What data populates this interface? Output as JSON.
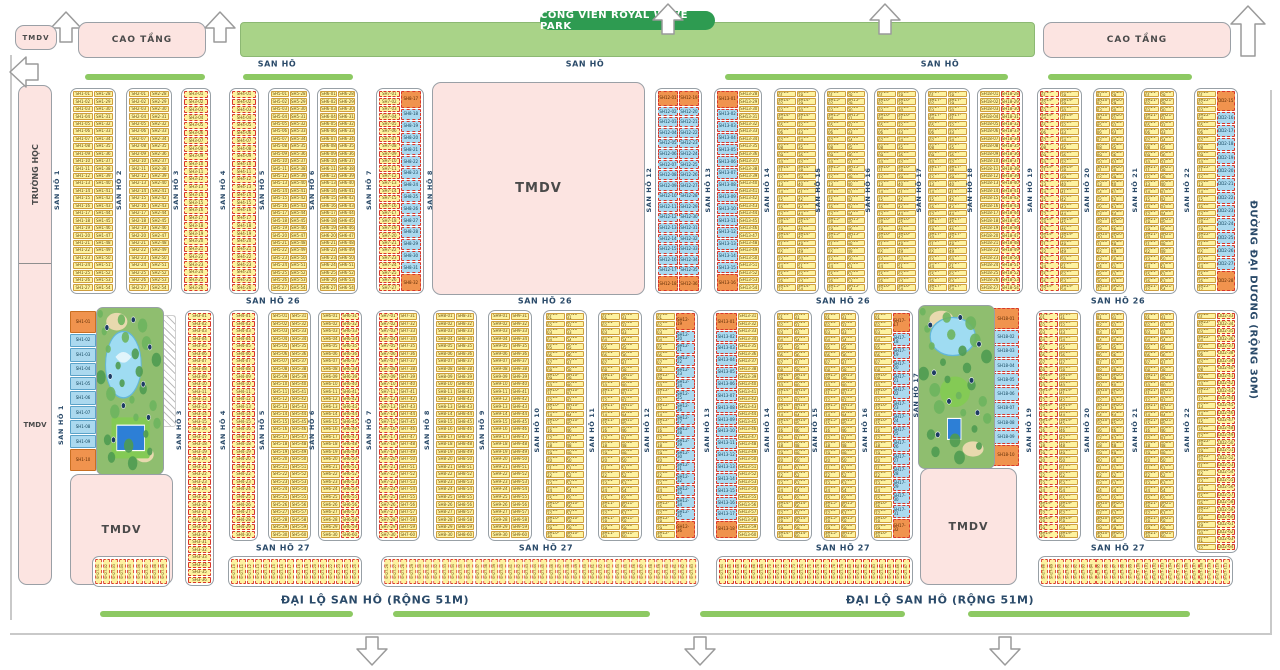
{
  "banner": {
    "label": "CÔNG VIÊN ROYAL WAVE PARK"
  },
  "left_column": {
    "top_label": "TRƯỜNG HỌC",
    "bottom_label": "TMDV",
    "x": 18,
    "y": 85,
    "w": 34,
    "h": 500,
    "divider_y": 177
  },
  "area_blocks": [
    {
      "id": "tmdv-top-left",
      "label": "TMDV",
      "x": 15,
      "y": 25,
      "w": 42,
      "h": 25,
      "fs": 7
    },
    {
      "id": "cao-tang-left",
      "label": "CAO TẦNG",
      "x": 78,
      "y": 22,
      "w": 128,
      "h": 36,
      "fs": 9
    },
    {
      "id": "cao-tang-right",
      "label": "CAO TẦNG",
      "x": 1043,
      "y": 22,
      "w": 188,
      "h": 36,
      "fs": 9
    },
    {
      "id": "tmdv-center",
      "label": "TMDV",
      "x": 432,
      "y": 82,
      "w": 213,
      "h": 213,
      "fs": 13
    },
    {
      "id": "tmdv-bottom-left",
      "label": "TMDV",
      "x": 70,
      "y": 474,
      "w": 103,
      "h": 111,
      "fs": 11
    },
    {
      "id": "tmdv-bottom-right",
      "label": "TMDV",
      "x": 920,
      "y": 468,
      "w": 97,
      "h": 117,
      "fs": 11
    }
  ],
  "road_labels_h": [
    {
      "t": "SAN HÔ",
      "x": 277,
      "y": 64,
      "fs": 8
    },
    {
      "t": "SAN HÔ",
      "x": 585,
      "y": 64,
      "fs": 8
    },
    {
      "t": "SAN HÔ",
      "x": 940,
      "y": 64,
      "fs": 8
    },
    {
      "t": "SAN HÔ 26",
      "x": 273,
      "y": 301,
      "fs": 8
    },
    {
      "t": "SAN HÔ 26",
      "x": 545,
      "y": 301,
      "fs": 8
    },
    {
      "t": "SAN HÔ 26",
      "x": 843,
      "y": 301,
      "fs": 8
    },
    {
      "t": "SAN HÔ 26",
      "x": 1118,
      "y": 301,
      "fs": 8
    },
    {
      "t": "SAN HÔ 27",
      "x": 283,
      "y": 548,
      "fs": 8
    },
    {
      "t": "SAN HÔ 27",
      "x": 546,
      "y": 548,
      "fs": 8
    },
    {
      "t": "SAN HÔ 27",
      "x": 843,
      "y": 548,
      "fs": 8
    },
    {
      "t": "SAN HÔ 27",
      "x": 1118,
      "y": 548,
      "fs": 8
    },
    {
      "t": "ĐẠI LỘ SAN HÔ (RỘNG 51M)",
      "x": 375,
      "y": 600,
      "fs": 11
    },
    {
      "t": "ĐẠI LỘ SAN HÔ (RỘNG 51M)",
      "x": 940,
      "y": 600,
      "fs": 11
    }
  ],
  "road_labels_v": [
    {
      "t": "SAN HÔ 1",
      "x": 57,
      "cy": 190
    },
    {
      "t": "SAN HÔ 2",
      "x": 119,
      "cy": 190
    },
    {
      "t": "SAN HÔ 3",
      "x": 176,
      "cy": 190
    },
    {
      "t": "SAN HÔ 4",
      "x": 223,
      "cy": 190
    },
    {
      "t": "SAN HÔ 5",
      "x": 262,
      "cy": 190
    },
    {
      "t": "SAN HÔ 6",
      "x": 312,
      "cy": 190
    },
    {
      "t": "SAN HÔ 7",
      "x": 369,
      "cy": 190
    },
    {
      "t": "SAN HÔ 8",
      "x": 430,
      "cy": 190
    },
    {
      "t": "SAN HÔ 12",
      "x": 649,
      "cy": 190
    },
    {
      "t": "SAN HÔ 13",
      "x": 708,
      "cy": 190
    },
    {
      "t": "SAN HÔ 14",
      "x": 767,
      "cy": 190
    },
    {
      "t": "SAN HÔ 15",
      "x": 818,
      "cy": 190
    },
    {
      "t": "SAN HÔ 16",
      "x": 868,
      "cy": 190
    },
    {
      "t": "SAN HÔ 17",
      "x": 919,
      "cy": 190
    },
    {
      "t": "SAN HÔ 18",
      "x": 970,
      "cy": 190
    },
    {
      "t": "SAN HÔ 19",
      "x": 1030,
      "cy": 190
    },
    {
      "t": "SAN HÔ 20",
      "x": 1087,
      "cy": 190
    },
    {
      "t": "SAN HÔ 21",
      "x": 1135,
      "cy": 190
    },
    {
      "t": "SAN HÔ 22",
      "x": 1187,
      "cy": 190
    },
    {
      "t": "SAN HÔ 1",
      "x": 61,
      "cy": 425
    },
    {
      "t": "SAN HÔ 3",
      "x": 179,
      "cy": 430
    },
    {
      "t": "SAN HÔ 4",
      "x": 223,
      "cy": 430
    },
    {
      "t": "SAN HÔ 5",
      "x": 262,
      "cy": 430
    },
    {
      "t": "SAN HÔ 6",
      "x": 312,
      "cy": 430
    },
    {
      "t": "SAN HÔ 7",
      "x": 369,
      "cy": 430
    },
    {
      "t": "SAN HÔ 8",
      "x": 427,
      "cy": 430
    },
    {
      "t": "SAN HÔ 9",
      "x": 482,
      "cy": 430
    },
    {
      "t": "SAN HÔ 10",
      "x": 537,
      "cy": 430
    },
    {
      "t": "SAN HÔ 11",
      "x": 592,
      "cy": 430
    },
    {
      "t": "SAN HÔ 12",
      "x": 647,
      "cy": 430
    },
    {
      "t": "SAN HÔ 13",
      "x": 707,
      "cy": 430
    },
    {
      "t": "SAN HÔ 14",
      "x": 767,
      "cy": 430
    },
    {
      "t": "SAN HÔ 15",
      "x": 815,
      "cy": 430
    },
    {
      "t": "SAN HÔ 16",
      "x": 865,
      "cy": 430
    },
    {
      "t": "SAN HÔ 17",
      "x": 916,
      "cy": 395
    },
    {
      "t": "SAN HÔ 19",
      "x": 1029,
      "cy": 430
    },
    {
      "t": "SAN HÔ 20",
      "x": 1087,
      "cy": 430
    },
    {
      "t": "SAN HÔ 21",
      "x": 1135,
      "cy": 430
    },
    {
      "t": "SAN HÔ 22",
      "x": 1187,
      "cy": 430
    },
    {
      "t": "ĐƯỜNG ĐẠI DƯƠNG (RỘNG 30M)",
      "x": 1253,
      "cy": 300,
      "rot": 90,
      "fs": 10
    }
  ],
  "green_bars": {
    "top_y": 74,
    "bottom_y": 611,
    "top": [
      [
        85,
        120
      ],
      [
        243,
        110
      ],
      [
        725,
        283
      ],
      [
        1048,
        144
      ]
    ],
    "bottom": [
      [
        100,
        253
      ],
      [
        393,
        257
      ],
      [
        700,
        205
      ],
      [
        968,
        222
      ]
    ]
  },
  "strips": [
    {
      "x": 70,
      "y": 88,
      "w": 46,
      "h": 206,
      "rows": 27,
      "cols": [
        {
          "p": "SH1",
          "c": "y"
        },
        {
          "p": "SH1",
          "c": "y"
        }
      ]
    },
    {
      "x": 126,
      "y": 88,
      "w": 46,
      "h": 206,
      "rows": 27,
      "cols": [
        {
          "p": "SH2",
          "c": "y"
        },
        {
          "p": "SH2",
          "c": "y"
        }
      ]
    },
    {
      "x": 181,
      "y": 88,
      "w": 30,
      "h": 206,
      "rows": 26,
      "cols": [
        {
          "p": "SH3",
          "c": "y",
          "d": 1
        }
      ]
    },
    {
      "x": 229,
      "y": 88,
      "w": 30,
      "h": 206,
      "rows": 26,
      "cols": [
        {
          "p": "SH4",
          "c": "y",
          "d": 1
        }
      ]
    },
    {
      "x": 268,
      "y": 88,
      "w": 42,
      "h": 206,
      "rows": 27,
      "cols": [
        {
          "p": "SH5",
          "c": "y"
        },
        {
          "p": "SH5",
          "c": "y"
        }
      ]
    },
    {
      "x": 317,
      "y": 88,
      "w": 41,
      "h": 206,
      "rows": 27,
      "cols": [
        {
          "p": "SH6",
          "c": "y"
        },
        {
          "p": "SH6",
          "c": "y"
        }
      ]
    },
    {
      "x": 376,
      "y": 88,
      "w": 48,
      "h": 206,
      "rows": 27,
      "cols": [
        {
          "p": "SH7",
          "c": "y",
          "d": 1
        },
        {
          "p": "SH8",
          "c": "b",
          "caps": 1,
          "d": 1,
          "rows": 16
        }
      ]
    },
    {
      "x": 655,
      "y": 88,
      "w": 47,
      "h": 206,
      "rows": 18,
      "cols": [
        {
          "p": "SH12",
          "c": "b",
          "caps": 1,
          "d": 1
        },
        {
          "p": "SH12",
          "c": "b",
          "caps": 1,
          "d": 1
        }
      ]
    },
    {
      "x": 714,
      "y": 88,
      "w": 48,
      "h": 206,
      "rows": 27,
      "cols": [
        {
          "p": "SH13",
          "c": "b",
          "caps": 1,
          "d": 1,
          "rows": 16
        },
        {
          "p": "SH13",
          "c": "y"
        }
      ]
    },
    {
      "x": 774,
      "y": 88,
      "w": 45,
      "h": 206,
      "rows": 27,
      "cols": [
        {
          "p": "SH14",
          "c": "y"
        },
        {
          "p": "SH14",
          "c": "y"
        }
      ]
    },
    {
      "x": 824,
      "y": 88,
      "w": 44,
      "h": 206,
      "rows": 27,
      "cols": [
        {
          "p": "SH15",
          "c": "y"
        },
        {
          "p": "SH15",
          "c": "y"
        }
      ]
    },
    {
      "x": 874,
      "y": 88,
      "w": 45,
      "h": 206,
      "rows": 27,
      "cols": [
        {
          "p": "SH16",
          "c": "y"
        },
        {
          "p": "SH16",
          "c": "y"
        }
      ]
    },
    {
      "x": 925,
      "y": 88,
      "w": 45,
      "h": 206,
      "rows": 27,
      "cols": [
        {
          "p": "SH17",
          "c": "y"
        },
        {
          "p": "SH17",
          "c": "y"
        }
      ]
    },
    {
      "x": 977,
      "y": 88,
      "w": 46,
      "h": 206,
      "rows": 27,
      "cols": [
        {
          "p": "SH18",
          "c": "y"
        },
        {
          "p": "SH18",
          "c": "y",
          "d": 1
        }
      ]
    },
    {
      "x": 1037,
      "y": 88,
      "w": 45,
      "h": 206,
      "rows": 27,
      "cols": [
        {
          "p": "SH19",
          "c": "y",
          "d": 1
        },
        {
          "p": "SH19",
          "c": "y"
        }
      ]
    },
    {
      "x": 1093,
      "y": 88,
      "w": 34,
      "h": 206,
      "rows": 27,
      "cols": [
        {
          "p": "SH20",
          "c": "y"
        },
        {
          "p": "SH20",
          "c": "y"
        }
      ]
    },
    {
      "x": 1141,
      "y": 88,
      "w": 36,
      "h": 206,
      "rows": 27,
      "cols": [
        {
          "p": "SH21",
          "c": "y"
        },
        {
          "p": "SH21",
          "c": "y"
        }
      ]
    },
    {
      "x": 1194,
      "y": 88,
      "w": 44,
      "h": 206,
      "rows": 27,
      "cols": [
        {
          "p": "SH22",
          "c": "y"
        },
        {
          "p": "DD2",
          "c": "b",
          "caps": 1,
          "d": 1,
          "rows": 14
        }
      ]
    },
    {
      "x": 185,
      "y": 310,
      "w": 29,
      "h": 276,
      "rows": 36,
      "cols": [
        {
          "p": "SH3",
          "c": "y",
          "d": 1
        }
      ]
    },
    {
      "x": 229,
      "y": 310,
      "w": 29,
      "h": 231,
      "rows": 30,
      "cols": [
        {
          "p": "SH4",
          "c": "y",
          "d": 1
        }
      ]
    },
    {
      "x": 268,
      "y": 310,
      "w": 43,
      "h": 231,
      "rows": 30,
      "cols": [
        {
          "p": "SH5",
          "c": "y"
        },
        {
          "p": "SH5",
          "c": "y"
        }
      ]
    },
    {
      "x": 318,
      "y": 310,
      "w": 44,
      "h": 231,
      "rows": 30,
      "cols": [
        {
          "p": "SH6",
          "c": "y"
        },
        {
          "p": "SH6",
          "c": "y",
          "d": 1
        }
      ]
    },
    {
      "x": 376,
      "y": 310,
      "w": 44,
      "h": 231,
      "rows": 30,
      "cols": [
        {
          "p": "SH7",
          "c": "y",
          "d": 1
        },
        {
          "p": "SH7",
          "c": "y"
        }
      ]
    },
    {
      "x": 433,
      "y": 310,
      "w": 44,
      "h": 231,
      "rows": 30,
      "cols": [
        {
          "p": "SH8",
          "c": "y"
        },
        {
          "p": "SH8",
          "c": "y"
        }
      ]
    },
    {
      "x": 488,
      "y": 310,
      "w": 44,
      "h": 231,
      "rows": 30,
      "cols": [
        {
          "p": "SH9",
          "c": "y"
        },
        {
          "p": "SH9",
          "c": "y"
        }
      ]
    },
    {
      "x": 543,
      "y": 310,
      "w": 44,
      "h": 231,
      "rows": 30,
      "cols": [
        {
          "p": "SH10",
          "c": "y"
        },
        {
          "p": "SH10",
          "c": "y"
        }
      ]
    },
    {
      "x": 598,
      "y": 310,
      "w": 44,
      "h": 231,
      "rows": 30,
      "cols": [
        {
          "p": "SH11",
          "c": "y"
        },
        {
          "p": "SH11",
          "c": "y"
        }
      ]
    },
    {
      "x": 653,
      "y": 310,
      "w": 45,
      "h": 231,
      "rows": 30,
      "cols": [
        {
          "p": "SH12",
          "c": "y"
        },
        {
          "p": "SH12",
          "c": "b",
          "caps": 1,
          "d": 1,
          "rows": 18
        }
      ]
    },
    {
      "x": 713,
      "y": 310,
      "w": 48,
      "h": 231,
      "rows": 30,
      "cols": [
        {
          "p": "SH13",
          "c": "b",
          "caps": 1,
          "d": 1,
          "rows": 18
        },
        {
          "p": "SH13",
          "c": "y"
        }
      ]
    },
    {
      "x": 774,
      "y": 310,
      "w": 38,
      "h": 231,
      "rows": 30,
      "cols": [
        {
          "p": "SH14",
          "c": "y"
        },
        {
          "p": "SH14",
          "c": "y"
        }
      ]
    },
    {
      "x": 821,
      "y": 310,
      "w": 38,
      "h": 231,
      "rows": 30,
      "cols": [
        {
          "p": "SH15",
          "c": "y"
        },
        {
          "p": "SH15",
          "c": "y"
        }
      ]
    },
    {
      "x": 871,
      "y": 310,
      "w": 42,
      "h": 231,
      "rows": 30,
      "cols": [
        {
          "p": "SH16",
          "c": "y"
        },
        {
          "p": "SH17",
          "c": "b",
          "caps": 1,
          "d": 1,
          "rows": 16
        }
      ]
    },
    {
      "x": 1036,
      "y": 310,
      "w": 45,
      "h": 231,
      "rows": 30,
      "cols": [
        {
          "p": "SH19",
          "c": "y",
          "d": 1
        },
        {
          "p": "SH19",
          "c": "y"
        }
      ]
    },
    {
      "x": 1093,
      "y": 310,
      "w": 34,
      "h": 231,
      "rows": 30,
      "cols": [
        {
          "p": "SH20",
          "c": "y"
        },
        {
          "p": "SH20",
          "c": "y"
        }
      ]
    },
    {
      "x": 1141,
      "y": 310,
      "w": 36,
      "h": 231,
      "rows": 30,
      "cols": [
        {
          "p": "SH21",
          "c": "y"
        },
        {
          "p": "SH21",
          "c": "y"
        }
      ]
    },
    {
      "x": 1194,
      "y": 310,
      "w": 44,
      "h": 243,
      "rows": 32,
      "cols": [
        {
          "p": "SH22",
          "c": "y"
        },
        {
          "p": "DD2",
          "c": "y",
          "d": 1
        }
      ]
    },
    {
      "x": 70,
      "y": 311,
      "w": 26,
      "h": 160,
      "rows": 10,
      "bare": 1,
      "cols": [
        {
          "p": "SH1",
          "c": "b",
          "caps": 1
        }
      ]
    },
    {
      "x": 993,
      "y": 308,
      "w": 26,
      "h": 158,
      "rows": 10,
      "bare": 1,
      "cols": [
        {
          "p": "SH18",
          "c": "b",
          "caps": 1,
          "d": 1
        }
      ]
    }
  ],
  "parks": [
    {
      "x": 96,
      "y": 307,
      "w": 66,
      "h": 166
    },
    {
      "x": 918,
      "y": 305,
      "w": 75,
      "h": 162
    }
  ],
  "lot_boxes": {
    "prefix": "SH27",
    "y": 556,
    "h": 31,
    "boxes": [
      {
        "x": 92,
        "w": 78,
        "n": 9
      },
      {
        "x": 228,
        "w": 134,
        "n": 16
      },
      {
        "x": 381,
        "w": 318,
        "n": 38
      },
      {
        "x": 716,
        "w": 197,
        "n": 24
      },
      {
        "x": 1038,
        "w": 195,
        "n": 24
      }
    ]
  },
  "colors": {
    "yellow": "#fdf2a0",
    "blue": "#abd9ef",
    "orange": "#f0934e",
    "reddash": "#d8382b",
    "pink": "#fce4e1",
    "green_bar": "#8dc963",
    "banner": "#a9d388",
    "banner_pill": "#2e9b51",
    "navy": "#2a4a69",
    "park_green": "#8fbe6f",
    "lake": "#9fdcf2",
    "pool": "#2d7fd6"
  }
}
